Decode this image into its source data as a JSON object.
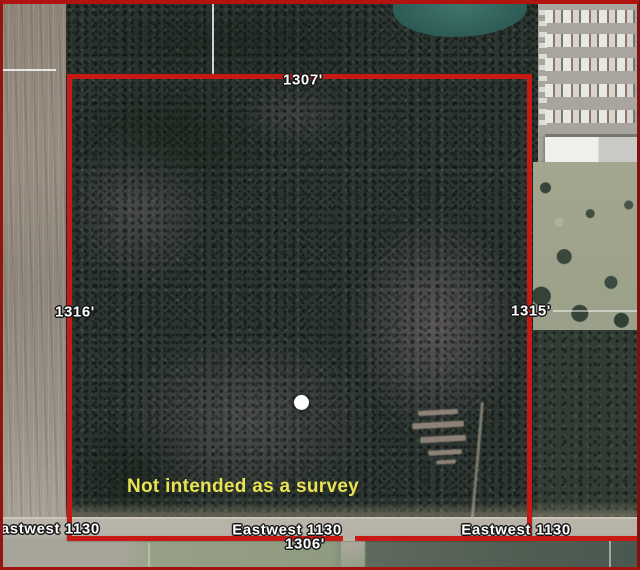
{
  "map": {
    "type": "aerial-parcel-map",
    "boundary_lengths": {
      "top": "1307'",
      "left": "1316'",
      "right": "1315'",
      "bottom": "1306'"
    },
    "road_labels": [
      "Eastwest 1130",
      "Eastwest 1130",
      "Eastwest 1130"
    ],
    "disclaimer": "Not intended as a survey",
    "marker": "white-dot-marker",
    "colors": {
      "boundary_red": "#c81a15",
      "frame_red": "#931511",
      "label_text": "#ffffff",
      "disclaimer_yellow": "#e8e254",
      "forest_dark": "#2c3531",
      "field_tan": "#93897d",
      "road_gray": "#b5b1a7",
      "pond_teal": "#33655d"
    }
  }
}
